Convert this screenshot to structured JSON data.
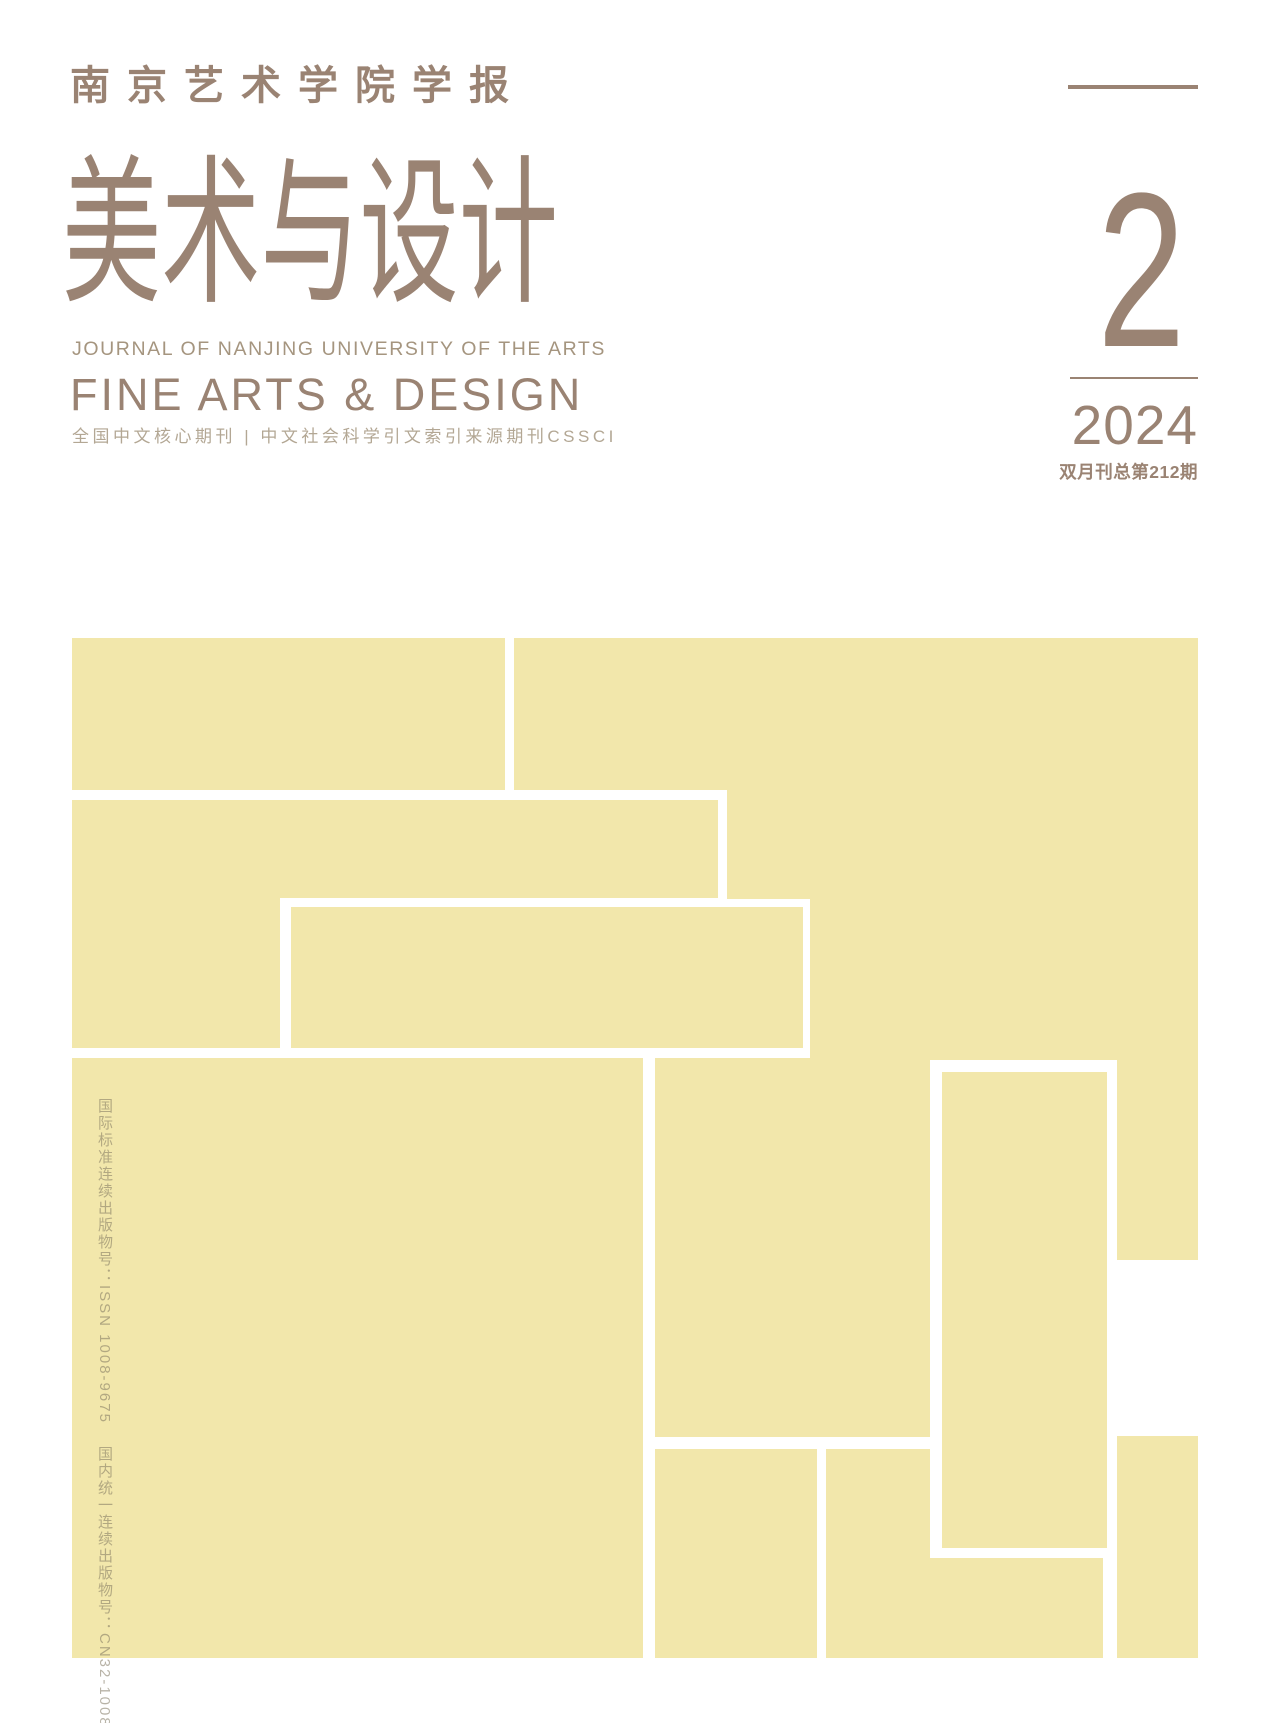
{
  "masthead": {
    "journal_cn": "南京艺术学院学报",
    "title_cn": "美术与设计",
    "journal_en": "JOURNAL OF NANJING UNIVERSITY OF THE ARTS",
    "title_en": "FINE ARTS & DESIGN",
    "indexing_line": "全国中文核心期刊 | 中文社会科学引文索引来源期刊CSSCI"
  },
  "issue": {
    "number": "2",
    "year": "2024",
    "frequency_line": "双月刊总第212期"
  },
  "registration": {
    "issn_vertical": "国际标准连续出版物号：ISSN 1008-9675",
    "cn_vertical": "国内统一连续出版物号：CN32-1008/J"
  },
  "colors": {
    "brand_brown": "#9a8373",
    "brand_brown_light": "#a5957f",
    "indexing_gray": "#b3a794",
    "mosaic_yellow": "#f2e7ab",
    "vertical_text_gray": "rgba(125,117,94,0.55)"
  }
}
